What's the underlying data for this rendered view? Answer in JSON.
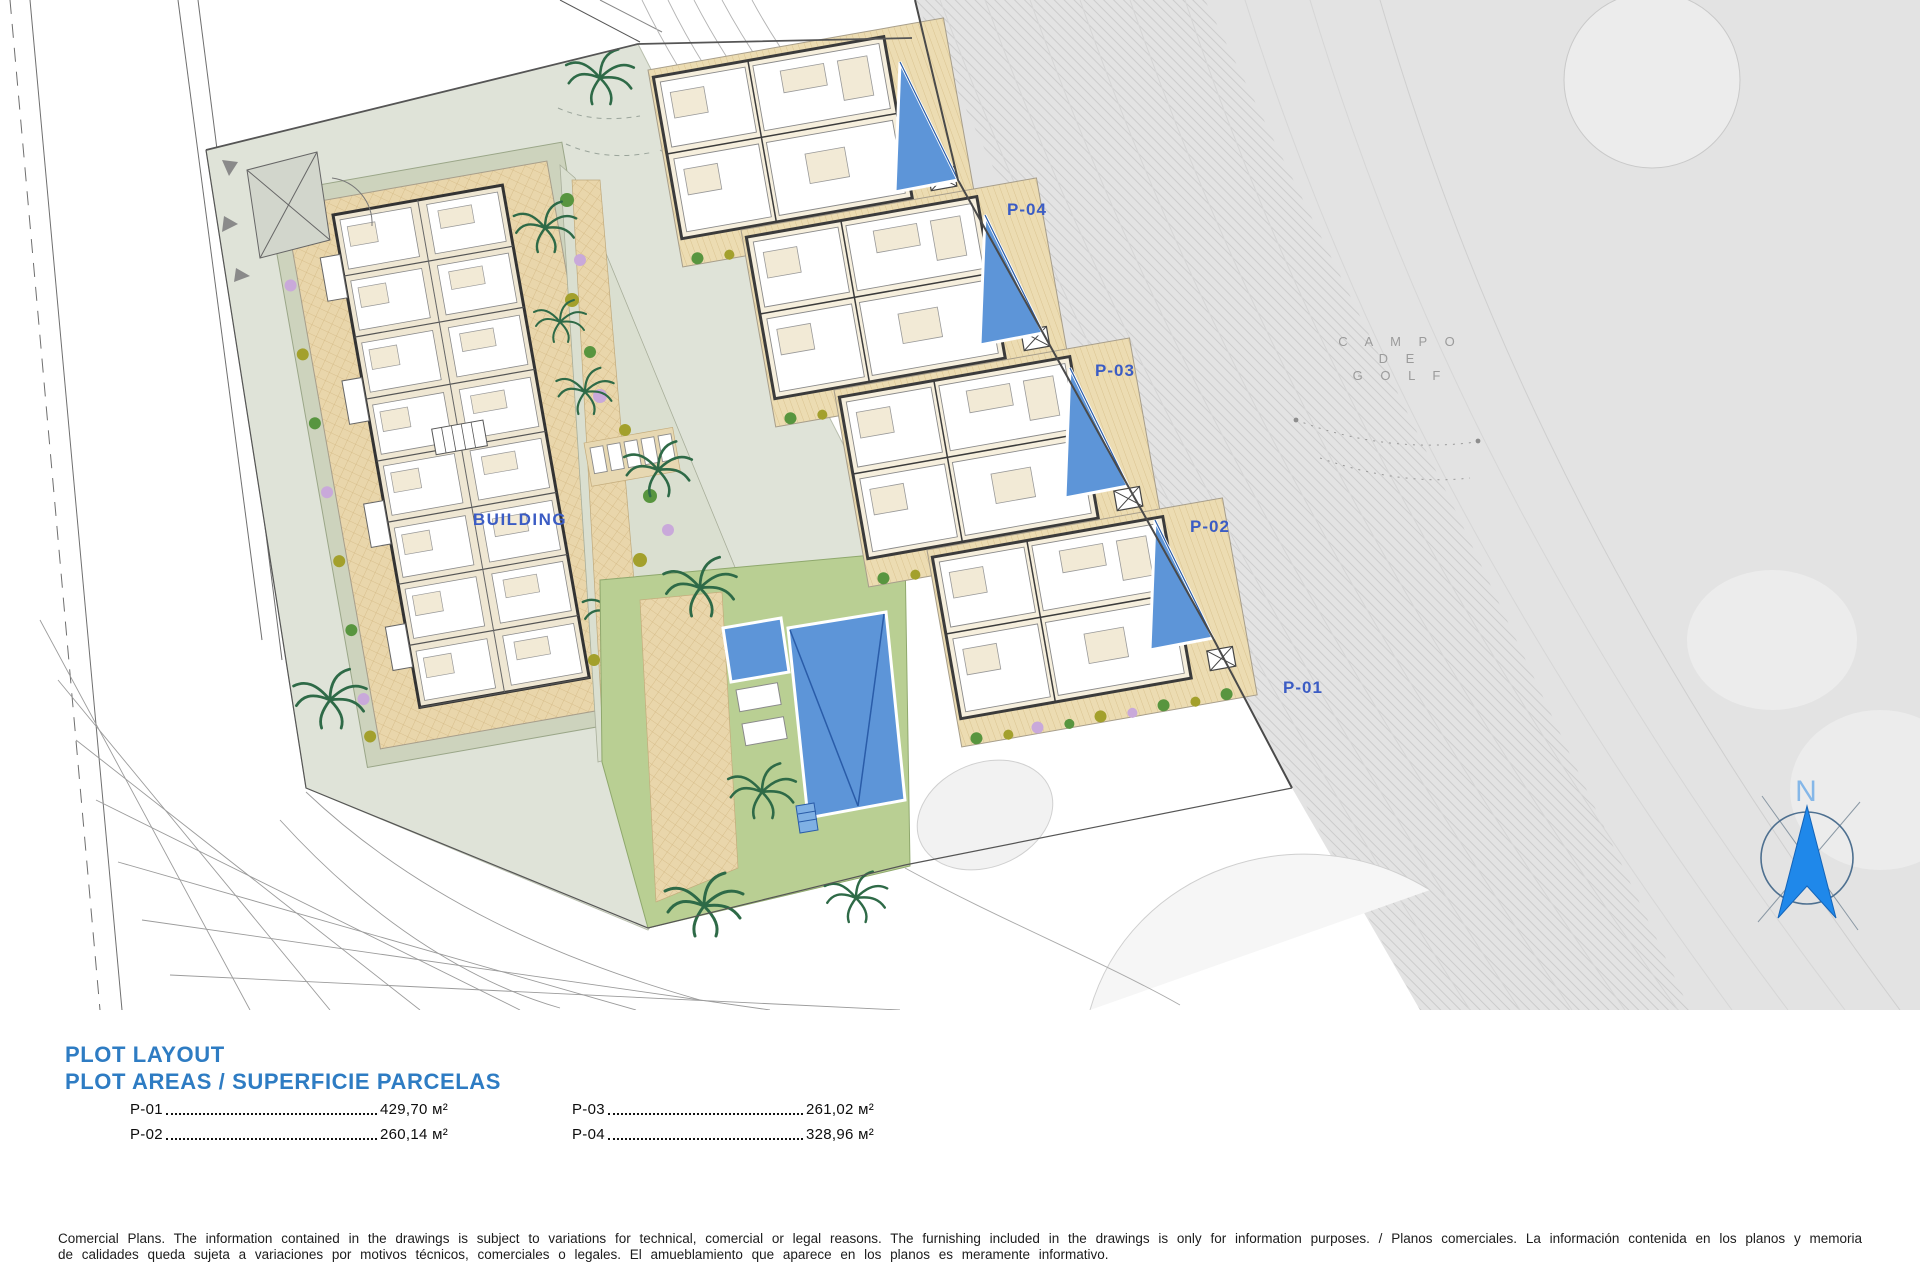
{
  "plan": {
    "building_label": "BUILDING",
    "plots": [
      {
        "label": "P-01",
        "area": "429,70 м²"
      },
      {
        "label": "P-02",
        "area": "260,14 м²"
      },
      {
        "label": "P-03",
        "area": "261,02 м²"
      },
      {
        "label": "P-04",
        "area": "328,96 м²"
      }
    ],
    "golf_label": {
      "line1": "C A M P O",
      "line2": "D E",
      "line3": "G O L F"
    },
    "north_label": "N"
  },
  "legend": {
    "title1": "PLOT LAYOUT",
    "title2": "PLOT AREAS / SUPERFICIE PARCELAS"
  },
  "disclaimer": "Comercial Plans. The information contained in the drawings is subject to variations for technical, comercial or legal reasons. The furnishing included in the drawings is only for information purposes. / Planos comerciales. La información contenida en los planos y memoria de calidades queda sujeta a variaciones por motivos técnicos, comerciales o legales. El amueblamiento que aparece en los planos es meramente informativo.",
  "colors": {
    "title_blue": "#2e7cc3",
    "label_blue": "#3b5cc4",
    "pool_blue": "#5d95d8",
    "terrace_tan": "#e9d6ab",
    "lawn_green": "#b9cf93",
    "golf_gray": "#e3e3e3",
    "compass_blue": "#1f88ea"
  }
}
